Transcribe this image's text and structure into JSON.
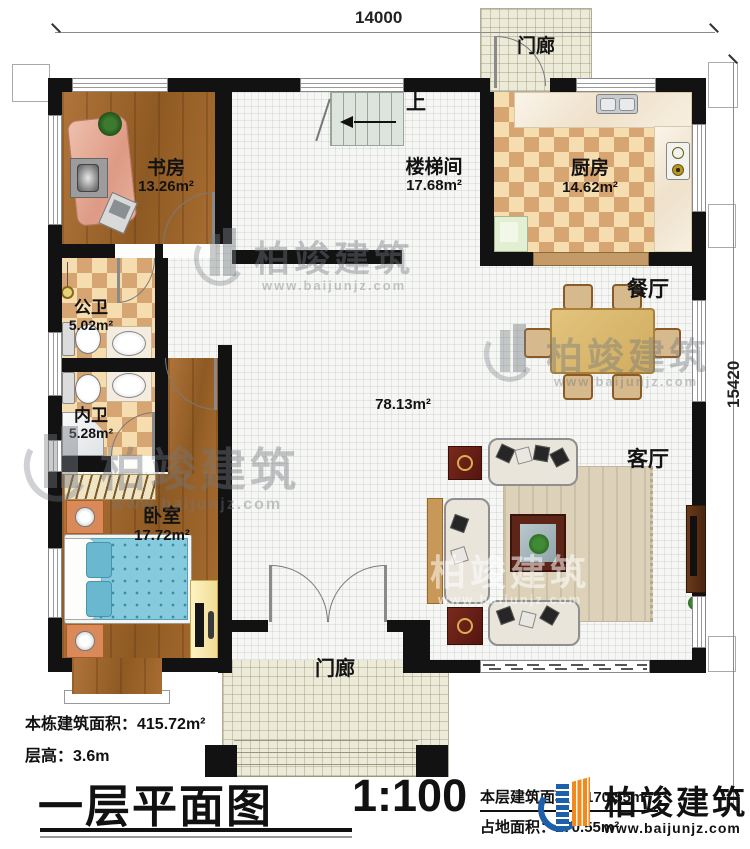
{
  "dimensions": {
    "width_top": "14000",
    "height_right": "15420"
  },
  "rooms": {
    "study": {
      "name": "书房",
      "area": "13.26m²"
    },
    "stairwell": {
      "name": "楼梯间",
      "area": "17.68m²"
    },
    "stairs_direction": "上",
    "kitchen": {
      "name": "厨房",
      "area": "14.62m²"
    },
    "porch_top": {
      "name": "门廊"
    },
    "dining": {
      "name": "餐厅"
    },
    "public_bath": {
      "name": "公卫",
      "area": "5.02m²"
    },
    "private_bath": {
      "name": "内卫",
      "area": "5.28m²"
    },
    "hall": {
      "area": "78.13m²"
    },
    "living": {
      "name": "客厅"
    },
    "bedroom": {
      "name": "卧室",
      "area": "17.72m²"
    },
    "porch_bottom": {
      "name": "门廊"
    }
  },
  "info": {
    "total_area": "本栋建筑面积：415.72m²",
    "floor_height": "层高：3.6m",
    "title": "一层平面图",
    "scale": "1:100",
    "floor_area": "本层建筑面积：170.55m²",
    "footprint_area": "占地面积：170.55m²"
  },
  "brand": {
    "name": "柏竣建筑",
    "url": "www.baijunjz.com",
    "blue": "#1d5fa8",
    "orange": "#f08a1e"
  },
  "watermark": {
    "name": "柏竣建筑",
    "url": "www.baijunjz.com"
  }
}
